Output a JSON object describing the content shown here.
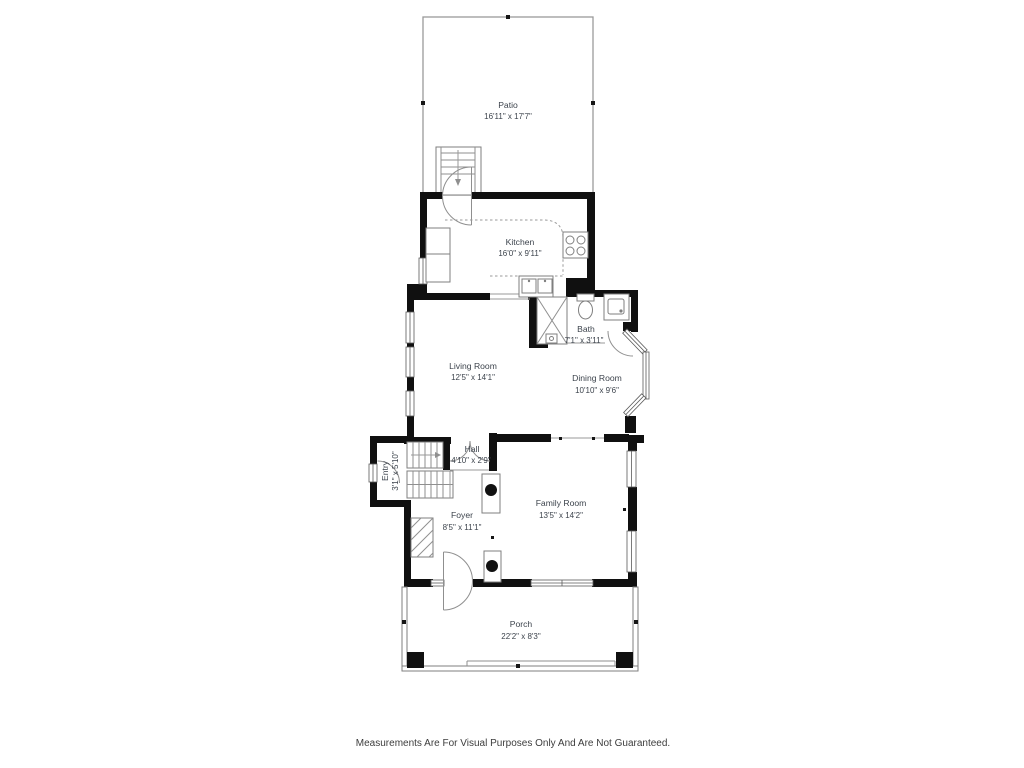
{
  "plan": {
    "rooms": [
      {
        "name": "Patio",
        "dims": "16'11\" x 17'7\""
      },
      {
        "name": "Kitchen",
        "dims": "16'0\" x 9'11\""
      },
      {
        "name": "Bath",
        "dims": "7'1\" x 3'11\""
      },
      {
        "name": "Living Room",
        "dims": "12'5\" x 14'1\""
      },
      {
        "name": "Dining Room",
        "dims": "10'10\" x 9'6\""
      },
      {
        "name": "Hall",
        "dims": "4'10\" x 2'9\""
      },
      {
        "name": "Entry",
        "dims": "3'1\" x 5'10\""
      },
      {
        "name": "Foyer",
        "dims": "8'5\" x 11'1\""
      },
      {
        "name": "Family Room",
        "dims": "13'5\" x 14'2\""
      },
      {
        "name": "Porch",
        "dims": "22'2\" x 8'3\""
      }
    ],
    "disclaimer": "Measurements Are For Visual Purposes Only And Are Not Guaranteed.",
    "colors": {
      "wall": "#101010",
      "line": "#8f8f8f",
      "label": "#3c434c"
    }
  }
}
